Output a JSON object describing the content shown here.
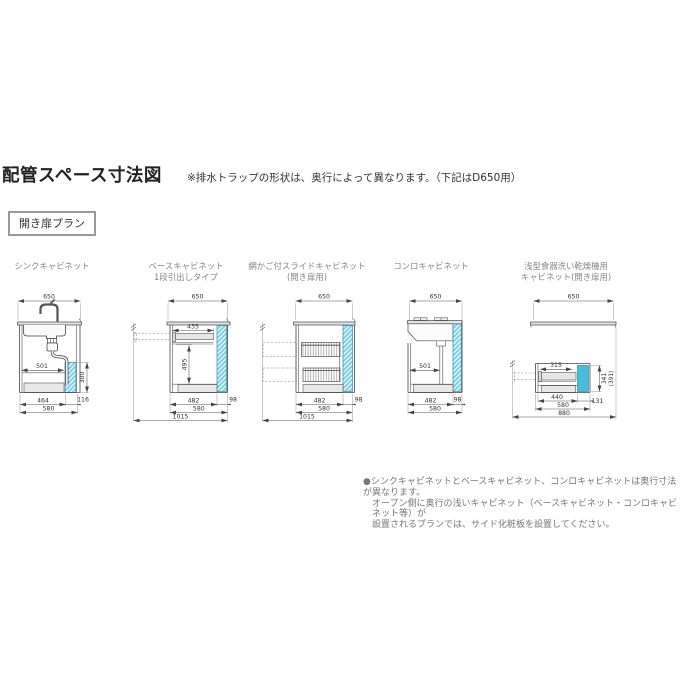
{
  "header": {
    "title": "配管スペース寸法図",
    "note": "※排水トラップの形状は、奥行によって異なります。（下記はD650用）",
    "plan_badge": "開き扉プラン"
  },
  "colors": {
    "pipe_space_hatch": "#79cfe5",
    "pipe_space_solid": "#49bcd9",
    "line": "#444"
  },
  "panels": [
    {
      "label1": "シンクキャビネット",
      "label2": "",
      "dims": {
        "top": "650",
        "depth": "501",
        "pipe_h": "300",
        "b1": "464",
        "b2": "116",
        "b3": "580"
      }
    },
    {
      "label1": "ベースキャビネット",
      "label2": "1段引出しタイプ",
      "dims": {
        "top": "650",
        "drawer": "435",
        "inner_h": "495",
        "b1": "482",
        "b2": "98",
        "b3": "580",
        "total": "1015"
      }
    },
    {
      "label1": "網かご付スライドキャビネット",
      "label2": "(開き扉用)",
      "dims": {
        "top": "650",
        "b1": "482",
        "b2": "98",
        "b3": "580",
        "total": "1015"
      }
    },
    {
      "label1": "コンロキャビネット",
      "label2": "",
      "dims": {
        "top": "650",
        "depth": "501",
        "b1": "482",
        "b2": "98",
        "b3": "580"
      }
    },
    {
      "label1": "浅型食器洗い乾燥機用",
      "label2": "キャビネット(開き扉用)",
      "dims": {
        "top": "650",
        "inner": "315",
        "h1": "341",
        "h2": "(391)",
        "b1": "440",
        "b2": "131",
        "b3": "580",
        "total": "880"
      }
    }
  ],
  "footnote": {
    "line1": "●シンクキャビネットとベースキャビネット、コンロキャビネットは奥行寸法が異なります。",
    "line2": "オープン側に奥行の浅いキャビネット（ベースキャビネット・コンロキャビネット等）が",
    "line3": "設置されるプランでは、サイド化粧板を設置してください。"
  }
}
